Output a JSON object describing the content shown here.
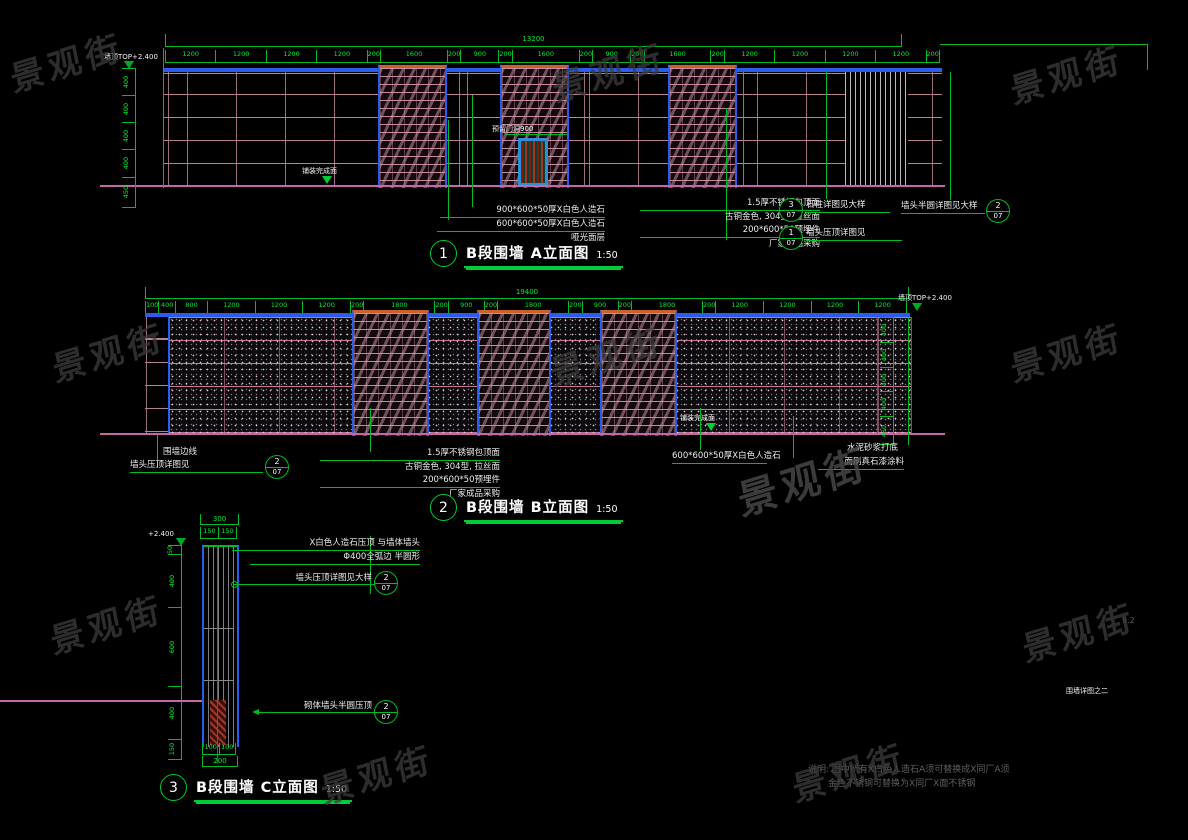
{
  "watermark": {
    "text": "景观街"
  },
  "page": {
    "page_num": "9.2",
    "sheet_label": "围墙详图之二"
  },
  "notes": {
    "line1": "说明: 图中所有X白色人造石A须可替换成X同厂A须",
    "line2": "金色不锈钢可替换为X同厂X面不锈钢"
  },
  "colors": {
    "dim_green": "#00bb22",
    "wall_blue": "#2b5cf0",
    "cap_orange": "#c8622a",
    "joint_pink": "#c387a0",
    "ground_magenta": "#c468a8",
    "brick_pink": "#cd91a5",
    "annotation_white": "#ececec"
  },
  "drawing1": {
    "number": "1",
    "title": "B段围墙 A立面图",
    "scale": "1:50",
    "overall_dim": "13200",
    "top_dims": [
      "1200",
      "1200",
      "1200",
      "1200",
      "200",
      "1600",
      "200",
      "900",
      "200",
      "1600",
      "200",
      "900",
      "200",
      "1600",
      "200",
      "1200",
      "1200",
      "1200",
      "1200",
      "200"
    ],
    "left_dims": [
      "400",
      "400",
      "400",
      "400",
      "450"
    ],
    "level_label": "墙顶TOP+2.400",
    "door_label": "预留门洞900",
    "ground_label": "铺装完成面",
    "ann_left": [
      "900*600*50厚X白色人造石",
      "600*600*50厚X白色人造石",
      "哑光面层"
    ],
    "ann_mid": [
      "1.5厚不锈钢包顶面",
      "古铜金色, 304型, 拉丝面",
      "200*600*50预埋件",
      "厂家成品采购"
    ],
    "callout1": {
      "num": "3",
      "sheet": "07",
      "label": "石柱详图见大样"
    },
    "callout2": {
      "num": "1",
      "sheet": "07",
      "label": "墙头压顶详图见"
    },
    "callout3": {
      "num": "2",
      "sheet": "07",
      "label": "墙头半圆详图见大样"
    }
  },
  "drawing2": {
    "number": "2",
    "title": "B段围墙 B立面图",
    "scale": "1:50",
    "overall_dim": "19400",
    "top_dims": [
      "100",
      "400",
      "800",
      "1200",
      "1200",
      "1200",
      "200",
      "1800",
      "200",
      "900",
      "200",
      "1800",
      "200",
      "900",
      "200",
      "1800",
      "200",
      "1200",
      "1200",
      "1200",
      "1200"
    ],
    "right_dims": [
      "400",
      "400",
      "400",
      "400",
      "450"
    ],
    "level_label": "墙顶TOP+2.400",
    "ground_label": "铺装完成面",
    "ann_edge": "围墙边线",
    "ann_edge2": "墙头压顶详图见",
    "edge_callout": {
      "num": "2",
      "sheet": "07"
    },
    "ann_mid": [
      "1.5厚不锈钢包顶面",
      "古铜金色, 304型, 拉丝面",
      "200*600*50预埋件",
      "厂家成品采购"
    ],
    "ann_stone": "600*600*50厚X白色人造石",
    "ann_paint": [
      "水泥砂浆打底",
      "面刷真石漆涂料"
    ]
  },
  "drawing3": {
    "number": "3",
    "title": "B段围墙 C立面图",
    "scale": "1:50",
    "level_label": "+2.400",
    "top_total": "300",
    "top_dims": [
      "150",
      "150"
    ],
    "left_dims": [
      "50",
      "400",
      "600",
      "400",
      "150"
    ],
    "bottom_dims": [
      "100",
      "100"
    ],
    "bottom_total": "200",
    "ann_top": [
      "X白色人造石压顶 与墙体墙头",
      "Φ400全弧边 半圆形"
    ],
    "callout_mid": {
      "num": "2",
      "sheet": "07",
      "label": "墙头压顶详图见大样"
    },
    "callout_low": {
      "num": "2",
      "sheet": "07",
      "label": "砌体墙头半圆压顶"
    }
  }
}
